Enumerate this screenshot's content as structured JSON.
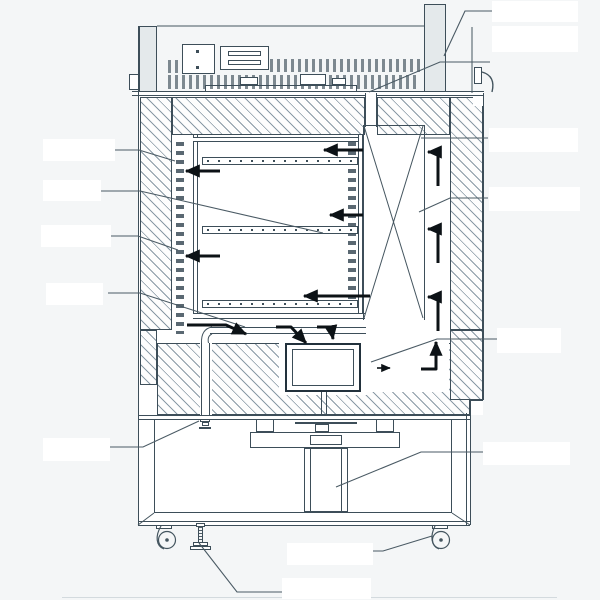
{
  "meta": {
    "description": "Technical cross-section line diagram of a laboratory incubator / climate chamber shown with insulated hatched walls, three perforated shelves, airflow arrows, circulation fan, motor, exhaust duct, casters and blank (redacted) callout labels",
    "diagram_type": "engineering-cross-section",
    "visible_text": ""
  },
  "colors": {
    "background": "#f4f6f7",
    "line": "#3d4e59",
    "hatch_line": "#627888",
    "bold_arrow": "#0c1216",
    "panel_fill": "#e4e9eb",
    "label_box": "#ffffff"
  },
  "components": {
    "control_deck": {
      "terminal_rows": 2,
      "component_boxes": 2
    },
    "chamber": {
      "shelves": 3,
      "perforated_liners": 2
    },
    "airflow": {
      "chamber_arrows": 5,
      "fan_inlet_arrows": 3,
      "right_channel_elbow_arrows": 3,
      "bottom_elbow_arrows": 1,
      "fan_outlet_arrow": 1
    },
    "fan_box": 1,
    "motor": 1,
    "drain_valve": 1,
    "exhaust_duct": 1,
    "casters": 2,
    "leveling_feet": 1
  },
  "callouts": {
    "left": [
      {
        "text": ""
      },
      {
        "text": ""
      },
      {
        "text": ""
      },
      {
        "text": ""
      },
      {
        "text": ""
      }
    ],
    "right": [
      {
        "text": ""
      },
      {
        "text": ""
      },
      {
        "text": ""
      },
      {
        "text": ""
      },
      {
        "text": ""
      },
      {
        "text": ""
      }
    ],
    "bottom": [
      {
        "text": ""
      },
      {
        "text": ""
      }
    ]
  }
}
